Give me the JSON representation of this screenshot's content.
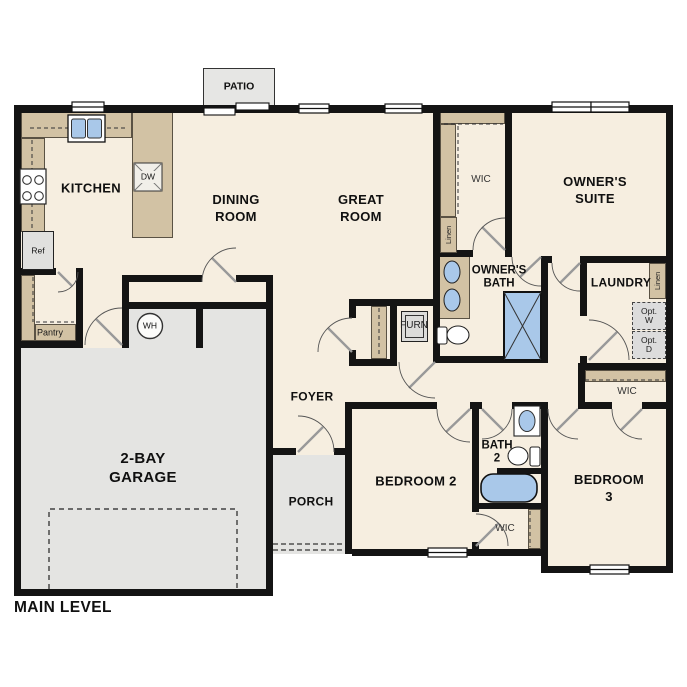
{
  "title": "MAIN LEVEL",
  "colors": {
    "floor": "#f6eee0",
    "hard_surface": "#e4e4e2",
    "counter": "#d2c2a4",
    "fixture_blue": "#a9c8e9",
    "wall": "#141414"
  },
  "rooms": {
    "patio": "PATIO",
    "kitchen": "KITCHEN",
    "dining": "DINING\nROOM",
    "great": "GREAT\nROOM",
    "owners_wic": "WIC",
    "owners_suite": "OWNER'S\nSUITE",
    "owners_bath": "OWNER'S\nBATH",
    "laundry": "LAUNDRY",
    "wic_bed3": "WIC",
    "foyer": "FOYER",
    "pantry": "Pantry",
    "garage": "2-BAY\nGARAGE",
    "porch": "PORCH",
    "bedroom2": "BEDROOM 2",
    "bath2": "BATH\n2",
    "bedroom3": "BEDROOM 3",
    "wic_bed2": "WIC"
  },
  "fixtures": {
    "dishwasher": "DW",
    "refrigerator": "Ref",
    "water_heater": "WH",
    "furnace": "FURN",
    "linen_wic": "Linen",
    "linen_laundry": "Linen",
    "opt_washer": "Opt.\nW",
    "opt_dryer": "Opt.\nD"
  }
}
